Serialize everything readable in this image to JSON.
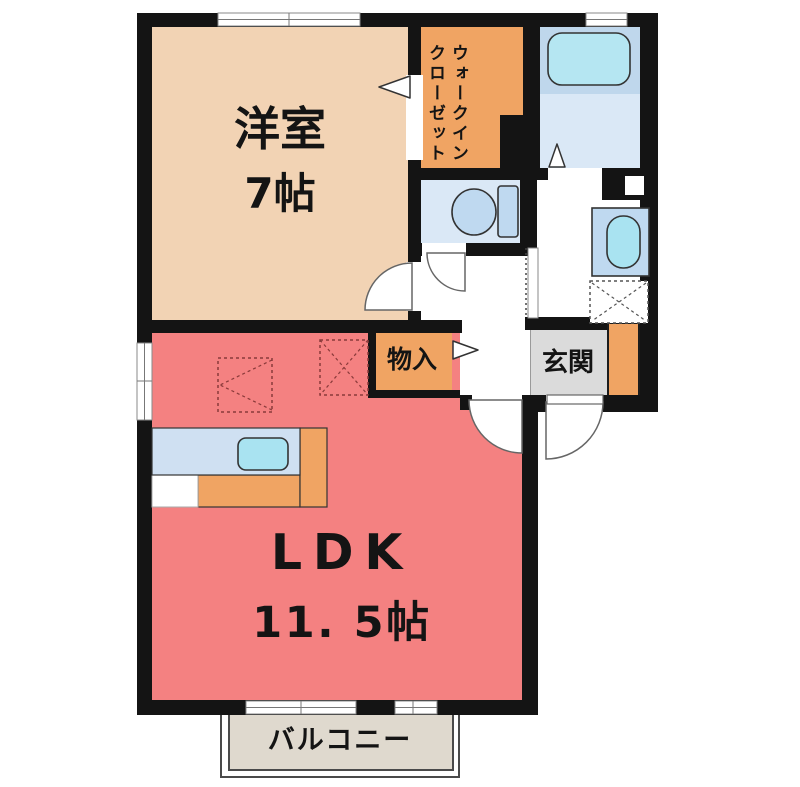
{
  "title": "1LDK間取り図",
  "rooms": {
    "western_room": {
      "name": "洋室",
      "size": "7帖"
    },
    "ldk": {
      "name": "LDK",
      "size": "11. 5帖"
    },
    "walk_in_closet": {
      "line1": "ウォークイン",
      "line2": "クローゼット"
    },
    "storage": {
      "name": "物入"
    },
    "entrance": {
      "name": "玄関"
    },
    "balcony": {
      "name": "バルコニー"
    }
  },
  "colors": {
    "wall": "#141414",
    "western_room_fill": "#F2D3B4",
    "ldk_fill": "#F48181",
    "closet_orange": "#F0A463",
    "bath_floor": "#DAE8F6",
    "bath_upper_band": "#BFD7EC",
    "bathtub_fill": "#B5E6F2",
    "fixture_blue": "#BFD9F0",
    "basin_cyan": "#A9E3F1",
    "kitchen_counter_blue": "#CFE0F2",
    "entrance_gray": "#DBDBDB",
    "balcony_fill": "#DFD9CE",
    "dashed_symbol": "#8a3a3a"
  }
}
